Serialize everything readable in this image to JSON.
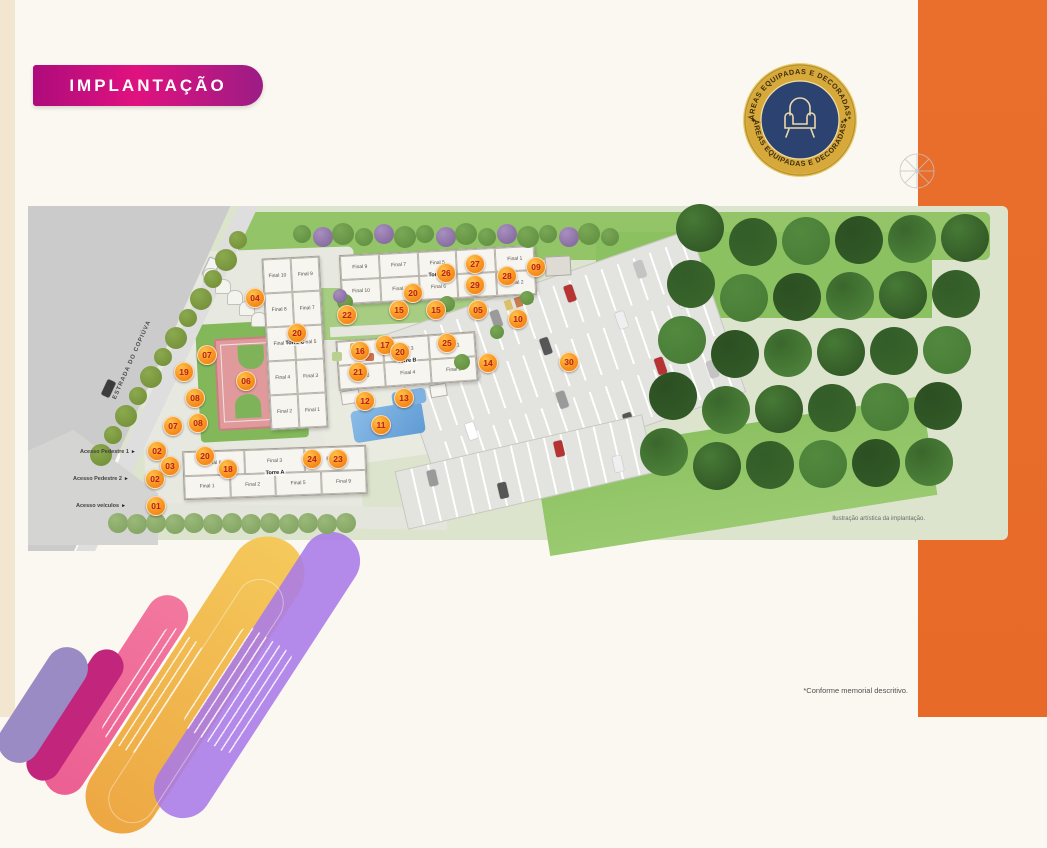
{
  "page": {
    "banner": "IMPLANTAÇÃO",
    "caption": "Ilustração artística da implantação.",
    "disclaimer": "*Conforme memorial descritivo."
  },
  "badge": {
    "arc_text_top": "ÁREAS EQUIPADAS E DECORADAS*",
    "arc_text_bottom": "ÁREAS EQUIPADAS E DECORADAS*",
    "star_left": "✦",
    "star_right": "✦",
    "icon": "armchair-icon",
    "colors": {
      "ring_gold": "#d7a93b",
      "inner_navy": "#2c4270"
    }
  },
  "plan": {
    "road_label": "ESTRADA DO COPIÚVA",
    "access": [
      {
        "label": "Acesso Pedestre 1",
        "x": 80,
        "y": 449
      },
      {
        "label": "Acesso Pedestre 2",
        "x": 73,
        "y": 476
      },
      {
        "label": "Acesso veículos",
        "x": 76,
        "y": 503
      }
    ],
    "towers": [
      {
        "name": "Torre A",
        "x": 183,
        "y": 448,
        "w": 182,
        "h": 47,
        "rot": -2,
        "rows": [
          [
            "Final 6",
            "Final 3",
            "Final 10"
          ],
          [
            "Final 1",
            "Final 2",
            "Final 5",
            "Final 9"
          ]
        ]
      },
      {
        "name": "Torre B",
        "x": 337,
        "y": 336,
        "w": 138,
        "h": 48,
        "rot": -4,
        "rows": [
          [
            "Final 5",
            "Final 3",
            "Final 1"
          ],
          [
            "Final 6",
            "Final 4",
            "Final 2"
          ]
        ]
      },
      {
        "name": "Torre C",
        "x": 266,
        "y": 257,
        "w": 56,
        "h": 170,
        "rot": -3,
        "rows": [
          [
            "Final 10",
            "Final 9"
          ],
          [
            "Final 8",
            "Final 7"
          ],
          [
            "Final 6",
            "Final 5"
          ],
          [
            "Final 4",
            "Final 3"
          ],
          [
            "Final 2",
            "Final 1"
          ]
        ]
      },
      {
        "name": "Torre D",
        "x": 340,
        "y": 250,
        "w": 194,
        "h": 48,
        "rot": -3,
        "rows": [
          [
            "Final 9",
            "Final 7",
            "Final 5",
            "Final 3",
            "Final 1"
          ],
          [
            "Final 10",
            "Final 8",
            "Final 6",
            "Final 4",
            "Final 2"
          ]
        ]
      }
    ],
    "markers": [
      {
        "n": "01",
        "x": 155,
        "y": 505
      },
      {
        "n": "02",
        "x": 156,
        "y": 450
      },
      {
        "n": "02",
        "x": 154,
        "y": 478
      },
      {
        "n": "03",
        "x": 169,
        "y": 465
      },
      {
        "n": "04",
        "x": 254,
        "y": 297
      },
      {
        "n": "05",
        "x": 477,
        "y": 309
      },
      {
        "n": "06",
        "x": 245,
        "y": 380
      },
      {
        "n": "07",
        "x": 206,
        "y": 354
      },
      {
        "n": "07",
        "x": 172,
        "y": 425
      },
      {
        "n": "08",
        "x": 194,
        "y": 397
      },
      {
        "n": "08",
        "x": 197,
        "y": 422
      },
      {
        "n": "09",
        "x": 535,
        "y": 266
      },
      {
        "n": "10",
        "x": 517,
        "y": 318
      },
      {
        "n": "11",
        "x": 380,
        "y": 424
      },
      {
        "n": "12",
        "x": 364,
        "y": 400
      },
      {
        "n": "13",
        "x": 403,
        "y": 397
      },
      {
        "n": "14",
        "x": 487,
        "y": 362
      },
      {
        "n": "15",
        "x": 398,
        "y": 309
      },
      {
        "n": "15",
        "x": 435,
        "y": 309
      },
      {
        "n": "16",
        "x": 359,
        "y": 350
      },
      {
        "n": "17",
        "x": 384,
        "y": 344
      },
      {
        "n": "18",
        "x": 227,
        "y": 468
      },
      {
        "n": "19",
        "x": 183,
        "y": 371
      },
      {
        "n": "20",
        "x": 296,
        "y": 332
      },
      {
        "n": "20",
        "x": 412,
        "y": 292
      },
      {
        "n": "20",
        "x": 399,
        "y": 351
      },
      {
        "n": "20",
        "x": 204,
        "y": 455
      },
      {
        "n": "21",
        "x": 357,
        "y": 371
      },
      {
        "n": "22",
        "x": 346,
        "y": 314
      },
      {
        "n": "23",
        "x": 337,
        "y": 458
      },
      {
        "n": "24",
        "x": 311,
        "y": 458
      },
      {
        "n": "25",
        "x": 446,
        "y": 342
      },
      {
        "n": "26",
        "x": 445,
        "y": 272
      },
      {
        "n": "27",
        "x": 474,
        "y": 263
      },
      {
        "n": "28",
        "x": 506,
        "y": 275
      },
      {
        "n": "29",
        "x": 474,
        "y": 284
      },
      {
        "n": "30",
        "x": 568,
        "y": 361
      }
    ]
  },
  "colors": {
    "accent_orange_band": "#ea6f2c",
    "banner_magenta": "#d4107f",
    "marker_orange": "#f79420",
    "marker_number": "#b71f1f"
  }
}
